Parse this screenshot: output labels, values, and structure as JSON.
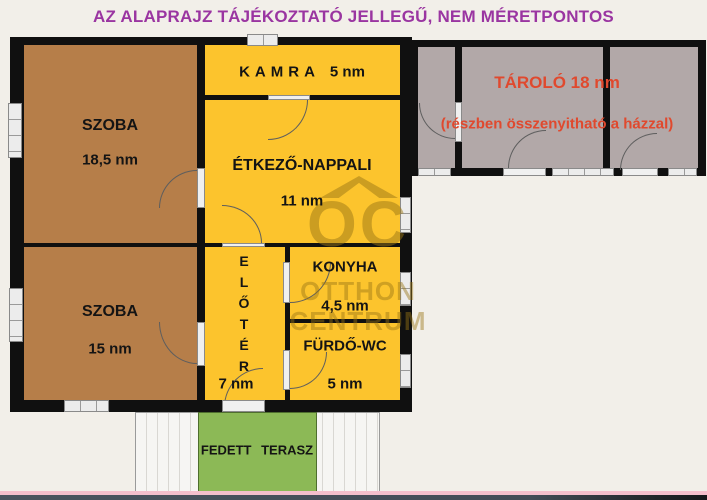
{
  "title": "AZ ALAPRAJZ TÁJÉKOZTATÓ JELLEGŰ, NEM MÉRETPONTOS",
  "rooms": {
    "szoba_top": {
      "name": "SZOBA",
      "area": "18,5 nm"
    },
    "kamra": {
      "name": "KAMRA",
      "area": "5 nm"
    },
    "etkezo_nappali": {
      "name": "ÉTKEZŐ-NAPPALI",
      "area": "11 nm"
    },
    "tarolo": {
      "name": "TÁROLÓ 18 nm",
      "note": "(részben összenyitható a házzal)"
    },
    "szoba_bottom": {
      "name": "SZOBA",
      "area": "15 nm"
    },
    "eloter": {
      "letters": [
        "E",
        "L",
        "Ő",
        "T",
        "É",
        "R"
      ],
      "area": "7 nm"
    },
    "konyha": {
      "name": "KONYHA",
      "area": "4,5 nm"
    },
    "furdo_wc": {
      "name": "FÜRDŐ-WC",
      "area": "5 nm"
    },
    "fedett_terasz": {
      "name": "FEDETT TERASZ"
    }
  },
  "watermark": {
    "brand": "OC",
    "line2": "OTTHON",
    "line3": "CENTRUM"
  },
  "colors": {
    "title_purple": "#9a35a1",
    "note_red": "#e0492e",
    "room_yellow": "#fcc42d",
    "room_brown": "#b67e49",
    "storage_gray": "#b2a8a8",
    "terrace_green": "#8cb956",
    "wall_black": "#101010",
    "background": "#f2efe9",
    "footer_pink": "#f4bfcc",
    "footer_slate": "#46505c"
  }
}
